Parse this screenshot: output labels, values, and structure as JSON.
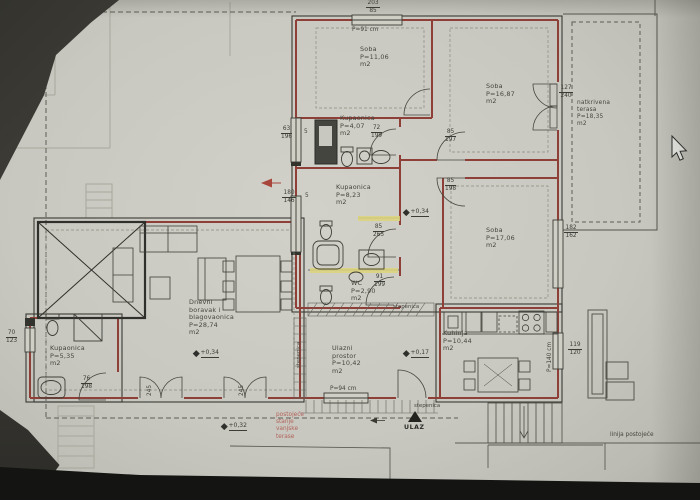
{
  "plan": {
    "rooms": {
      "soba1": {
        "name": "Soba",
        "area": "P=11,06",
        "unit": "m2"
      },
      "soba2": {
        "name": "Soba",
        "area": "P=16,87",
        "unit": "m2"
      },
      "soba3": {
        "name": "Soba",
        "area": "P=17,06",
        "unit": "m2"
      },
      "terasa": {
        "line1": "natkrivena",
        "line2": "terasa",
        "area": "P=18,35",
        "unit": "m2"
      },
      "kupaonica1": {
        "name": "Kupaonica",
        "area": "P=4,07",
        "unit": "m2"
      },
      "kupaonica2": {
        "name": "Kupaonica",
        "area": "P=8,23",
        "unit": "m2"
      },
      "kupaonica3": {
        "name": "Kupaonica",
        "area": "P=5,35",
        "unit": "m2"
      },
      "wc": {
        "name": "WC",
        "area": "P=2,90",
        "unit": "m2"
      },
      "dnevni": {
        "line1": "Dnevni",
        "line2": "boravak i",
        "line3": "blagovaonica",
        "area": "P=28,74",
        "unit": "m2"
      },
      "ulazni": {
        "line1": "Ulazni",
        "line2": "prostor",
        "area": "P=10,42",
        "unit": "m2"
      },
      "kuhinja": {
        "name": "Kuhinja",
        "area": "P=10,44",
        "unit": "m2"
      }
    },
    "levels": {
      "hall": "+0,34",
      "living": "+0,34",
      "entry": "+0,17",
      "outside": "+0,32"
    },
    "openings": {
      "top_window": {
        "top": "203",
        "bot": "85"
      },
      "top_parapet": "P=91 cm",
      "win_left1": {
        "top": "63",
        "bot": "196"
      },
      "win_left2": {
        "top": "180",
        "bot": "146"
      },
      "door_kup1": {
        "top": "72",
        "bot": "199"
      },
      "door_soba2": {
        "top": "85",
        "bot": "197"
      },
      "door_soba3": {
        "top": "85",
        "bot": "198"
      },
      "door_kup2": {
        "top": "85",
        "bot": "265"
      },
      "door_wc": {
        "top": "91",
        "bot": "199"
      },
      "door_terasa": {
        "top": "127",
        "bot": "240"
      },
      "win_soba3": {
        "top": "182",
        "bot": "162"
      },
      "win_kuhinja": {
        "top": "119",
        "bot": "120"
      },
      "win_kup3": {
        "top": "70",
        "bot": "123"
      },
      "door_kup3": {
        "top": "76",
        "bot": "198"
      },
      "parapet_entry": "P=94 cm",
      "parapet_kuhinja": "P=140 cm",
      "wall5a": "5",
      "wall5b": "5",
      "dim245a": "245",
      "dim245b": "245"
    },
    "annotations": {
      "ulaz": "ULAZ",
      "stepenica_hall": "stepenica",
      "stepenica_side": "stepenica",
      "stepenica_porch": "stepenica",
      "red_note": {
        "line1": "postojeće",
        "line2": "stanje",
        "line3": "vanjske",
        "line4": "terase"
      },
      "existing_line": "linija postojeće"
    }
  }
}
